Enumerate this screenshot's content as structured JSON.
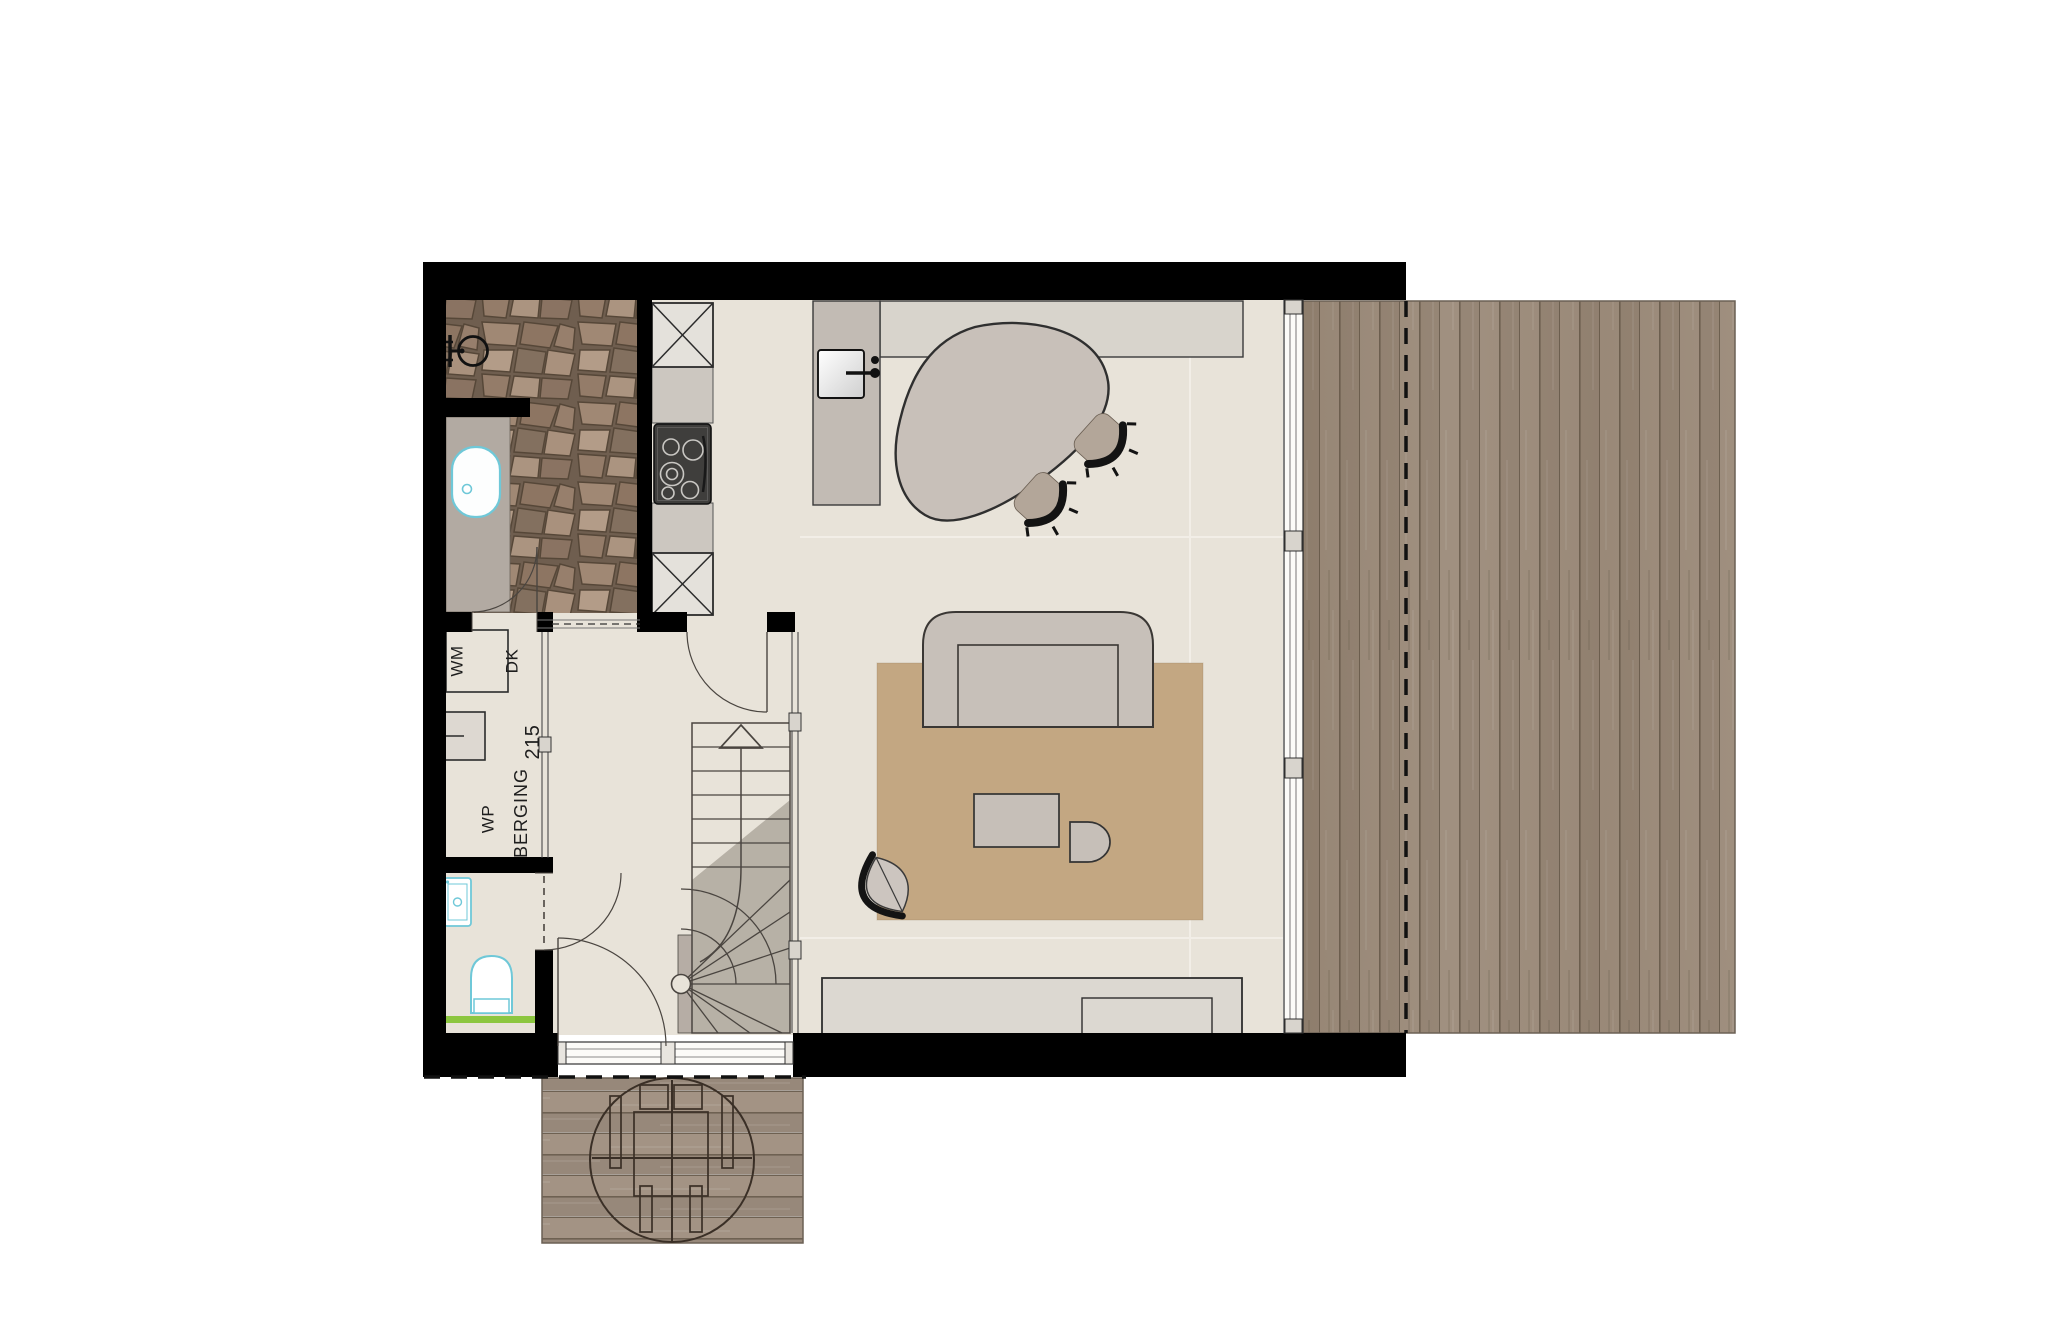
{
  "plan": {
    "type": "floor-plan",
    "labels": {
      "wm": "WM",
      "dk": "DK",
      "wp": "WP",
      "berging": "BERGING",
      "dim_215": "215"
    },
    "colors": {
      "wall": "#000000",
      "floor": "#e8e3d9",
      "stone_floor": "#8a7463",
      "wood_deck": "#a09081",
      "rug": "#c3a782",
      "furniture": "#c6bfb8",
      "counter": "#d8d4cc",
      "sanitary_outline": "#6fc8d8",
      "shelf_green": "#8cc63f",
      "hob": "#3f3e3c"
    }
  }
}
